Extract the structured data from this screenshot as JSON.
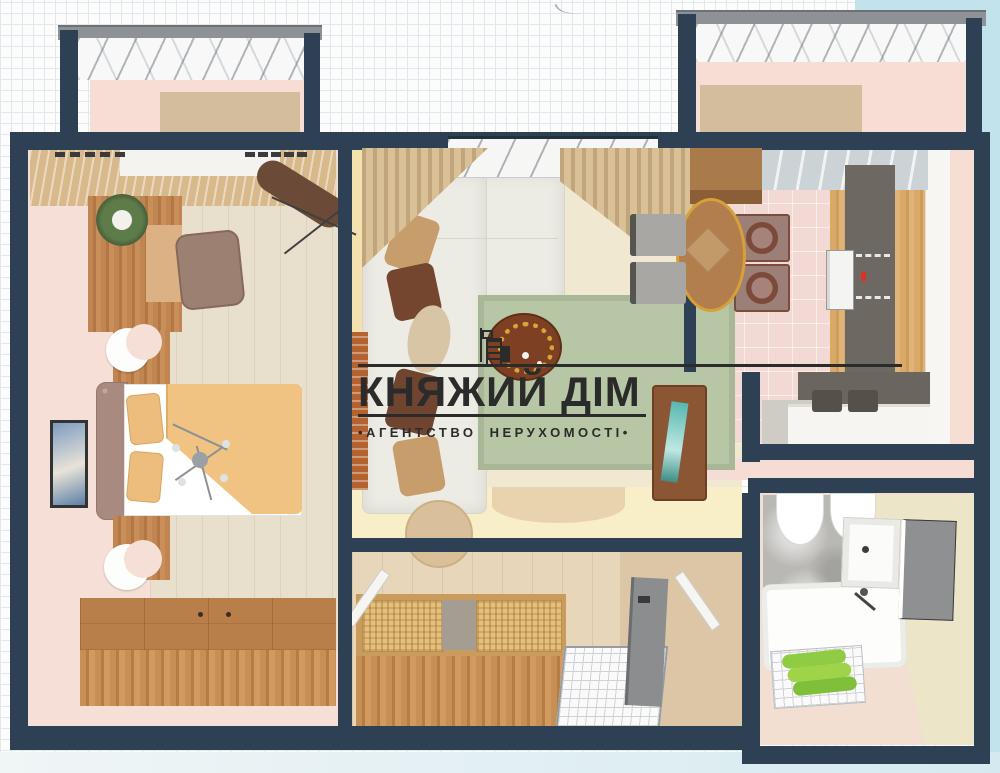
{
  "watermark": {
    "title": "КНЯЖИЙ ДІМ",
    "subtitle": "•АГЕНТСТВО НЕРУХОМОСТІ•",
    "logo_icon": "buildings-icon",
    "ink_color": "#2b2b2b"
  },
  "palette": {
    "wall": "#2e4154",
    "background_blue": "#c2e2ec",
    "graph_grid": "#dfe9ec",
    "floor_pink": "#f6dfd6",
    "floor_wood": "#e9dfcd",
    "floor_cream": "#f1e8d1",
    "accent_yellow_wall": "#f3e2ad",
    "rug_green": "#b7c6a4",
    "towel_green": "#9ed34a",
    "blanket_orange": "#f1c382",
    "oven_indicator_red": "#d63426",
    "balcony_rail_gray": "#8e9296"
  }
}
